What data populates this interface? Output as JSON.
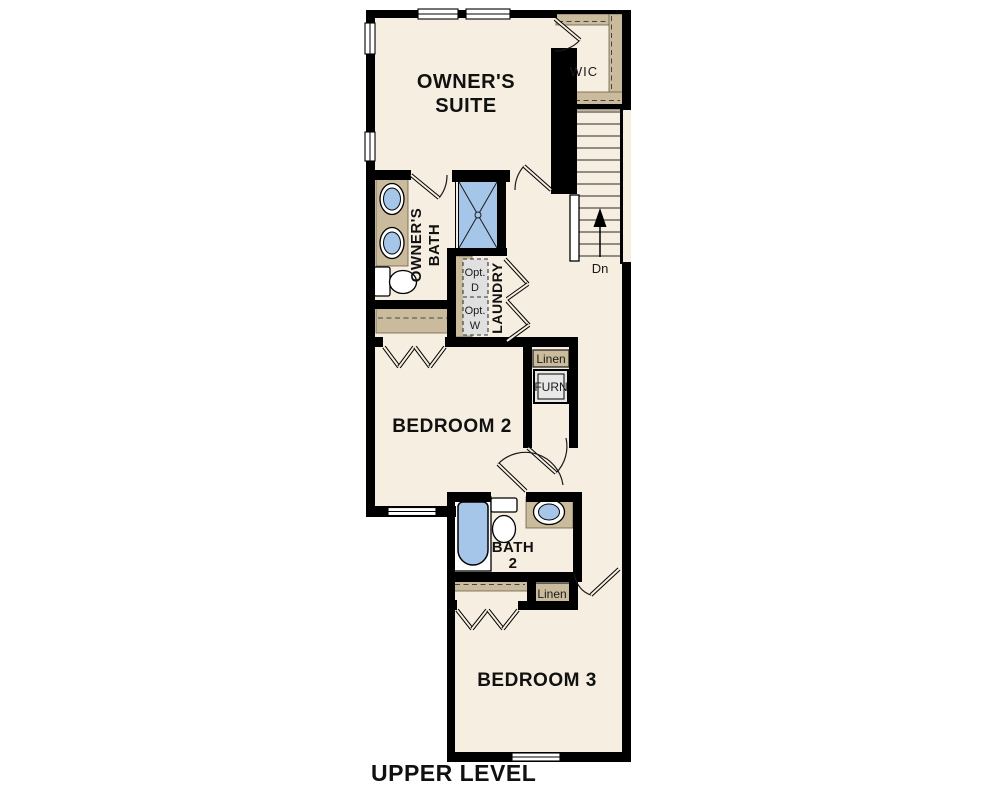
{
  "title": "UPPER LEVEL",
  "colors": {
    "floor": "#f6eee0",
    "wall": "#000000",
    "casework_tan": "#cbbb9d",
    "fixture_blue": "#a5c6e8",
    "appliance_gray": "#e0e0e0",
    "background": "#ffffff"
  },
  "rooms": {
    "owners_suite": {
      "line1": "OWNER'S",
      "line2": "SUITE"
    },
    "wic": {
      "label": "WIC"
    },
    "owners_bath": {
      "line1": "OWNER'S",
      "line2": "BATH"
    },
    "laundry": {
      "label": "LAUNDRY",
      "opt_dryer_line1": "Opt.",
      "opt_dryer_line2": "D",
      "opt_washer_line1": "Opt.",
      "opt_washer_line2": "W"
    },
    "stairs": {
      "down_label": "Dn"
    },
    "hall_closet": {
      "linen_label": "Linen",
      "furnace_label": "FURN"
    },
    "bedroom2": {
      "label": "BEDROOM 2"
    },
    "bath2": {
      "line1": "BATH",
      "line2": "2"
    },
    "bed3_closet": {
      "linen_label": "Linen"
    },
    "bedroom3": {
      "label": "BEDROOM 3"
    }
  }
}
